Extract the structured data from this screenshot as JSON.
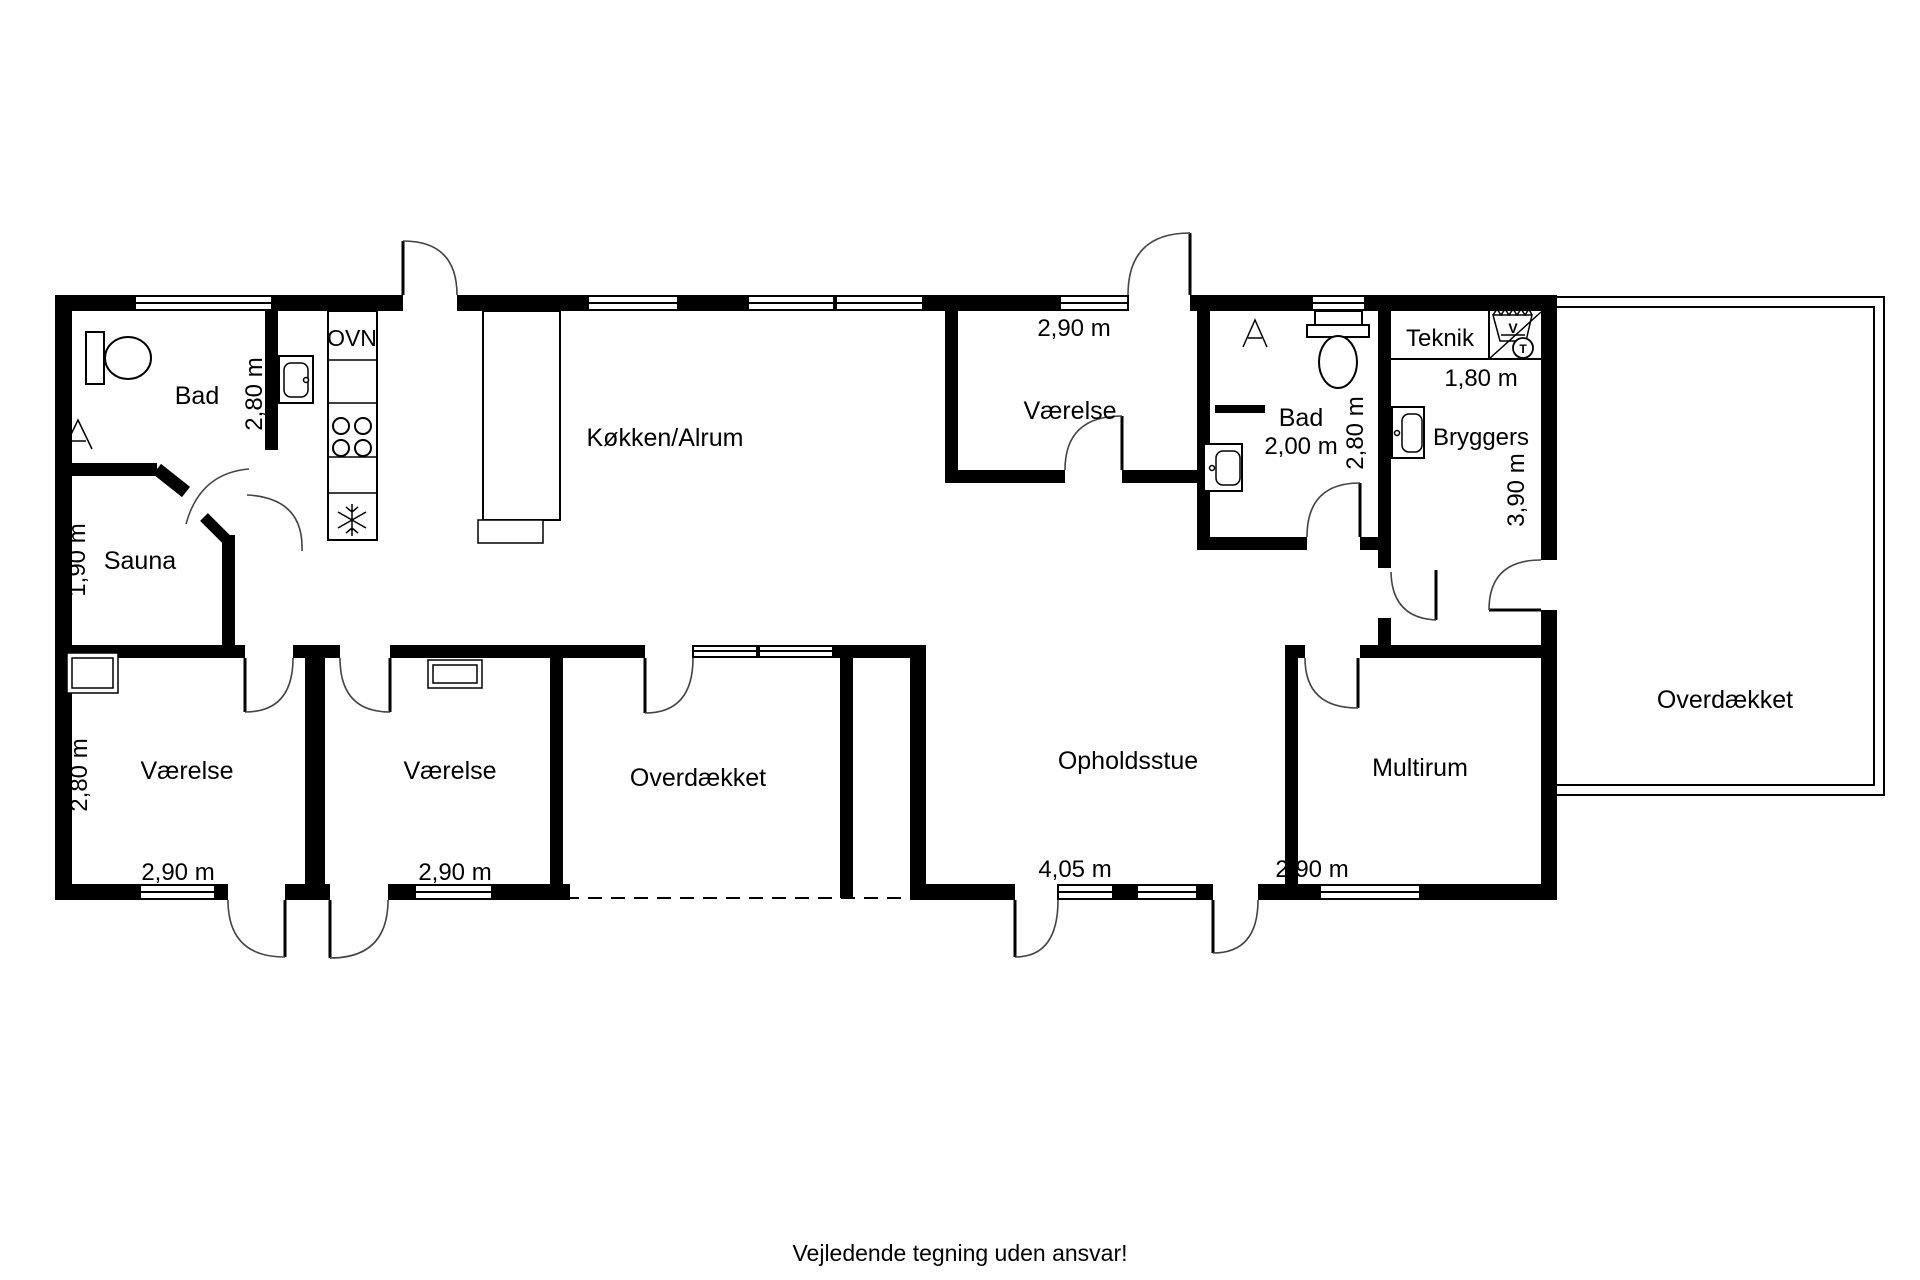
{
  "colors": {
    "wall": "#000000",
    "line": "#000000",
    "background": "#ffffff"
  },
  "labels": {
    "bad_top_left": "Bad",
    "bad_top_left_depth": "2,80 m",
    "sauna": "Sauna",
    "sauna_depth": "1,90 m",
    "oven": "OVN",
    "kitchen": "Køkken/Alrum",
    "bedroom_top": "Værelse",
    "bedroom_top_width": "2,90 m",
    "bad_right": "Bad",
    "bad_right_width": "2,00 m",
    "bad_right_depth": "2,80 m",
    "teknik": "Teknik",
    "bryggers": "Bryggers",
    "bryggers_width": "1,80 m",
    "bryggers_depth": "3,90 m",
    "washer": "V",
    "dryer": "T",
    "bedroom_left": "Værelse",
    "bedroom_left_depth": "2,80 m",
    "bedroom_left_width": "2,90 m",
    "bedroom_mid": "Værelse",
    "bedroom_mid_width": "2,90 m",
    "terrace_center": "Overdækket",
    "living_room": "Opholdsstue",
    "living_room_width": "4,05 m",
    "multiroom": "Multirum",
    "multiroom_width": "2,90 m",
    "terrace_right": "Overdækket",
    "footer": "Vejledende tegning uden ansvar!"
  }
}
